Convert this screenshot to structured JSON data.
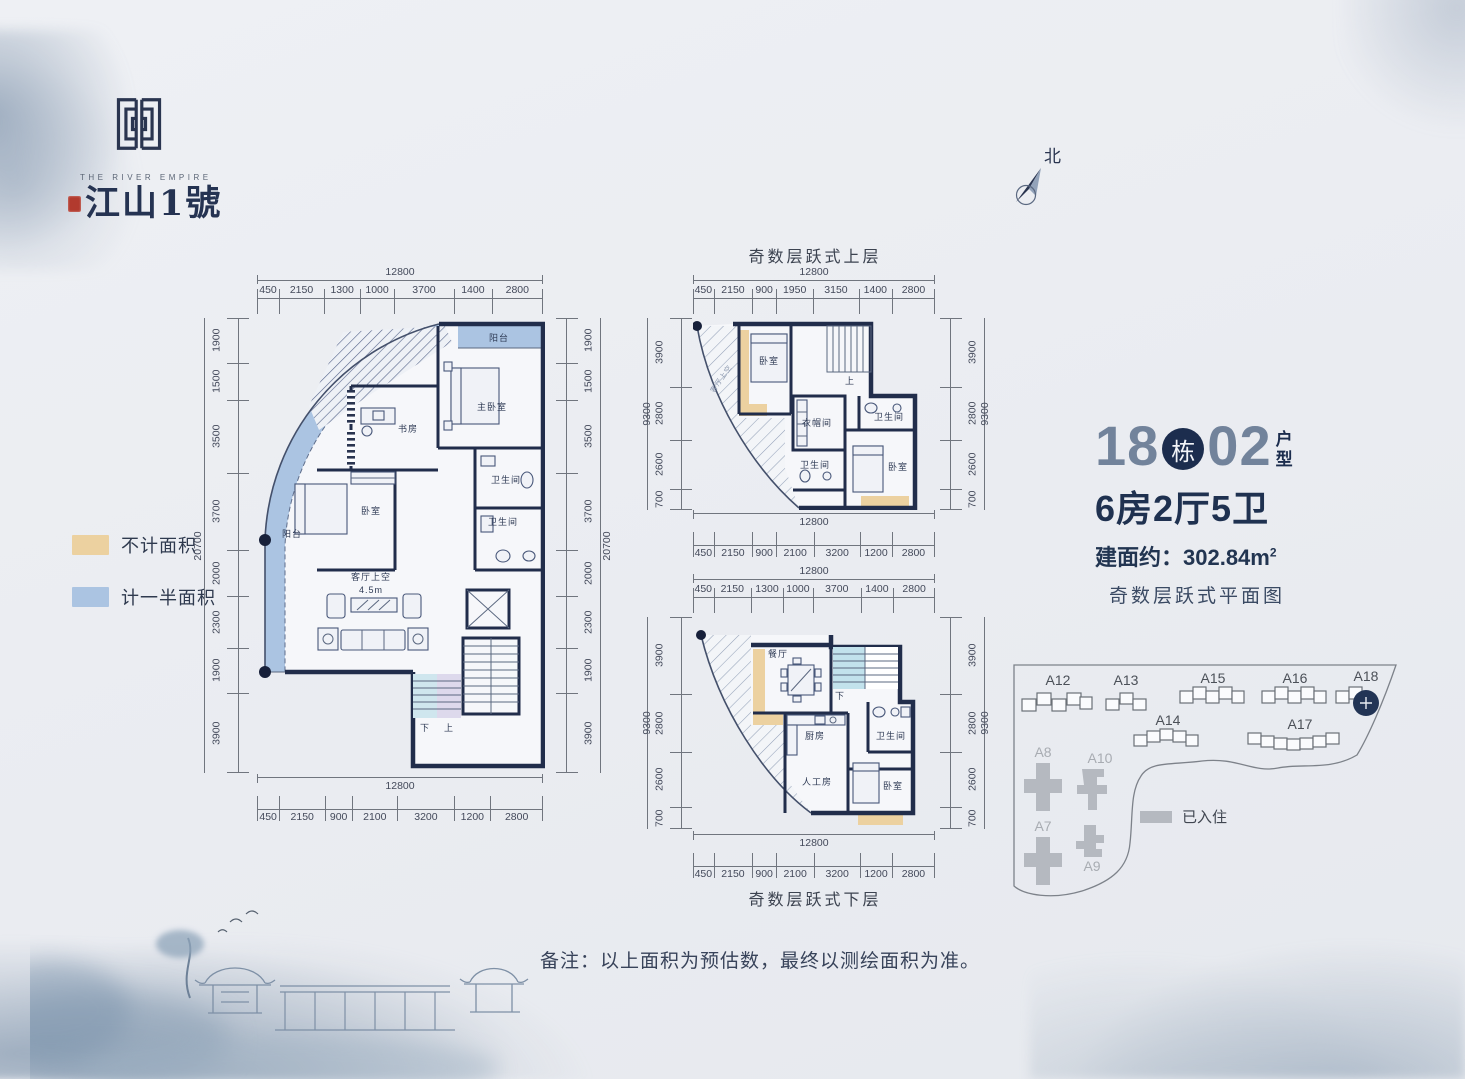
{
  "colors": {
    "wall": "#212d4b",
    "half": "#abc4e2",
    "tan": "#ecd1a0",
    "steel": "#72839b"
  },
  "logo": {
    "brand_en": "THE RIVER EMPIRE",
    "brand_cn": "江山1號"
  },
  "north_label": "北",
  "legend": {
    "not_counted": "不计面积",
    "half_counted": "计一半面积"
  },
  "unit_info": {
    "building_no": "18",
    "building_label": "栋",
    "unit_no": "02",
    "type_char_1": "户",
    "type_char_2": "型",
    "rooms": "6房2厅5卫",
    "area_label": "建面约：302.84m",
    "area_sup": "2",
    "subtitle": "奇数层跃式平面图"
  },
  "note": "备注：以上面积为预估数，最终以测绘面积为准。",
  "plans": {
    "main": {
      "dims_top": {
        "total": "12800",
        "segments": [
          450,
          2150,
          1300,
          1000,
          3700,
          1400,
          2800
        ]
      },
      "dims_bottom": {
        "total": "12800",
        "segments": [
          450,
          2150,
          900,
          2100,
          3200,
          1200,
          2800
        ]
      },
      "dims_left": {
        "total": "20700",
        "segments": [
          1900,
          1500,
          3500,
          3700,
          2000,
          2300,
          1900,
          3900
        ]
      },
      "dims_right": {
        "total": "20700",
        "segments": [
          1900,
          1500,
          3500,
          3700,
          2000,
          2300,
          1900,
          3900
        ]
      },
      "labels": {
        "balcony_top": "阳台",
        "master_bedroom": "主卧室",
        "study": "书房",
        "bedroom": "卧室",
        "bath_1": "卫生间",
        "bath_2": "卫生间",
        "living_void": "客厅上空",
        "living_height": "4.5m",
        "balcony_left": "阳台",
        "stair_down": "下",
        "stair_up": "上"
      }
    },
    "upper": {
      "title": "奇数层跃式上层",
      "dims_top": {
        "total": "12800",
        "segments": [
          450,
          2150,
          900,
          1950,
          3150,
          1400,
          2800
        ]
      },
      "dims_bottom": {
        "total": "12800",
        "segments": [
          450,
          2150,
          900,
          2100,
          3200,
          1200,
          2800
        ]
      },
      "dims_left": {
        "total": "9300",
        "segments": [
          3900,
          2800,
          2600,
          700
        ]
      },
      "dims_right": {
        "total": "9300",
        "segments": [
          3900,
          2800,
          2600,
          700
        ]
      },
      "labels": {
        "bedroom_1": "卧室",
        "stair_up": "上",
        "cloakroom": "衣帽间",
        "bath_1": "卫生间",
        "bath_2": "卫生间",
        "bedroom_2": "卧室",
        "void_note": "客厅上空"
      }
    },
    "lower": {
      "title": "奇数层跃式下层",
      "dims_top": {
        "total": "12800",
        "segments": [
          450,
          2150,
          1300,
          1000,
          3700,
          1400,
          2800
        ]
      },
      "dims_bottom": {
        "total": "12800",
        "segments": [
          450,
          2150,
          900,
          2100,
          3200,
          1200,
          2800
        ]
      },
      "dims_left": {
        "total": "9300",
        "segments": [
          3900,
          2800,
          2600,
          700
        ]
      },
      "dims_right": {
        "total": "9300",
        "segments": [
          3900,
          2800,
          2600,
          700
        ]
      },
      "labels": {
        "dining": "餐厅",
        "stair_down": "下",
        "kitchen": "厨房",
        "maid_room": "人工房",
        "bath": "卫生间",
        "bedroom": "卧室"
      }
    }
  },
  "site_map": {
    "labels": {
      "a12": "A12",
      "a13": "A13",
      "a15": "A15",
      "a16": "A16",
      "a18": "A18",
      "a14": "A14",
      "a17": "A17",
      "a8": "A8",
      "a10": "A10",
      "a7": "A7",
      "a9": "A9"
    },
    "legend_occupied": "已入住"
  }
}
